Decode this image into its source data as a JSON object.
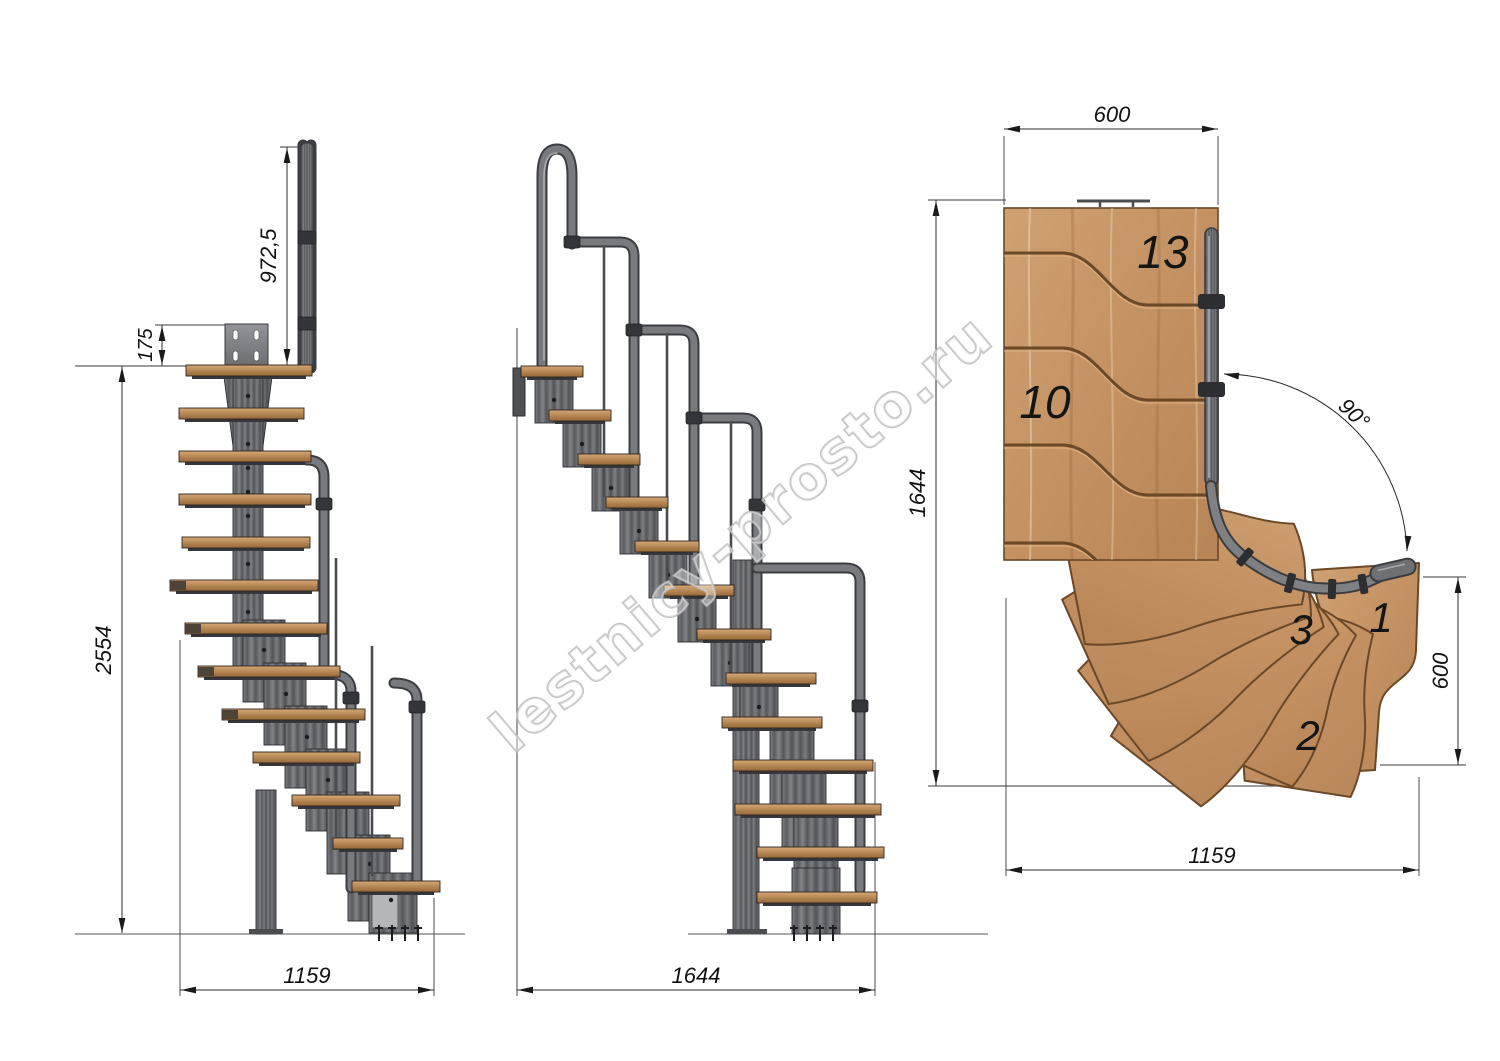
{
  "watermark": {
    "text": "lestnicy-prosto.ru"
  },
  "front_view": {
    "dim_handrail_height": "972,5",
    "dim_mount_plate": "175",
    "dim_total_height": "2554",
    "dim_length": "1159"
  },
  "side_view": {
    "dim_length": "1644"
  },
  "plan_view": {
    "dim_flight_width": "600",
    "dim_total_depth": "1644",
    "dim_entry_step_width": "600",
    "dim_total_length": "1159",
    "dim_turn_angle": "90°",
    "steps": {
      "s13": "13",
      "s10": "10",
      "s3": "3",
      "s2": "2",
      "s1": "1"
    }
  },
  "colors": {
    "background": "#ffffff",
    "wood": "#c59a6c",
    "wood_outline": "#6b4827",
    "tread_face": "#b5824f",
    "metal": "#5f6165",
    "metal_light": "#96989b",
    "dimension_line": "#2b2b2b",
    "watermark_gray": "#b7b7b7"
  }
}
